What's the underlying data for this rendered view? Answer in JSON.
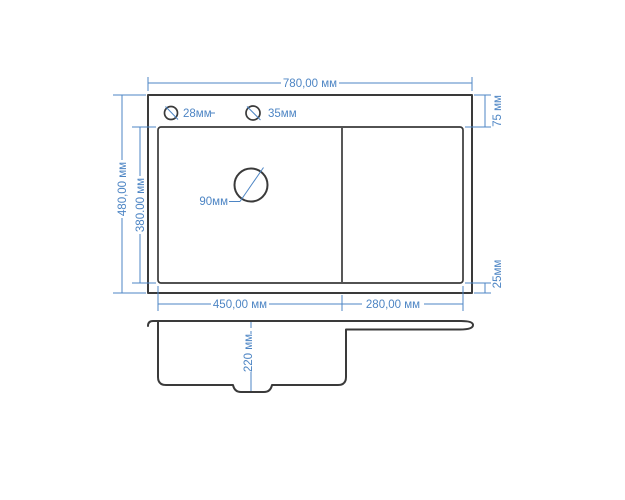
{
  "colors": {
    "dimension_blue": "#4d85c4",
    "outline_dark": "#3a3a3a",
    "background": "#ffffff"
  },
  "top_view": {
    "total_width": "780,00 мм",
    "total_depth": "480,00 мм",
    "bowl_depth": "380.00 мм",
    "top_offset": "75 мм",
    "bottom_offset": "25мм",
    "bowl_width": "450,00 мм",
    "drainboard_width": "280,00 мм",
    "tap_hole_small": "28мм",
    "tap_hole_large": "35мм",
    "drain_hole": "90мм"
  },
  "side_view": {
    "bowl_height": "220 мм"
  }
}
